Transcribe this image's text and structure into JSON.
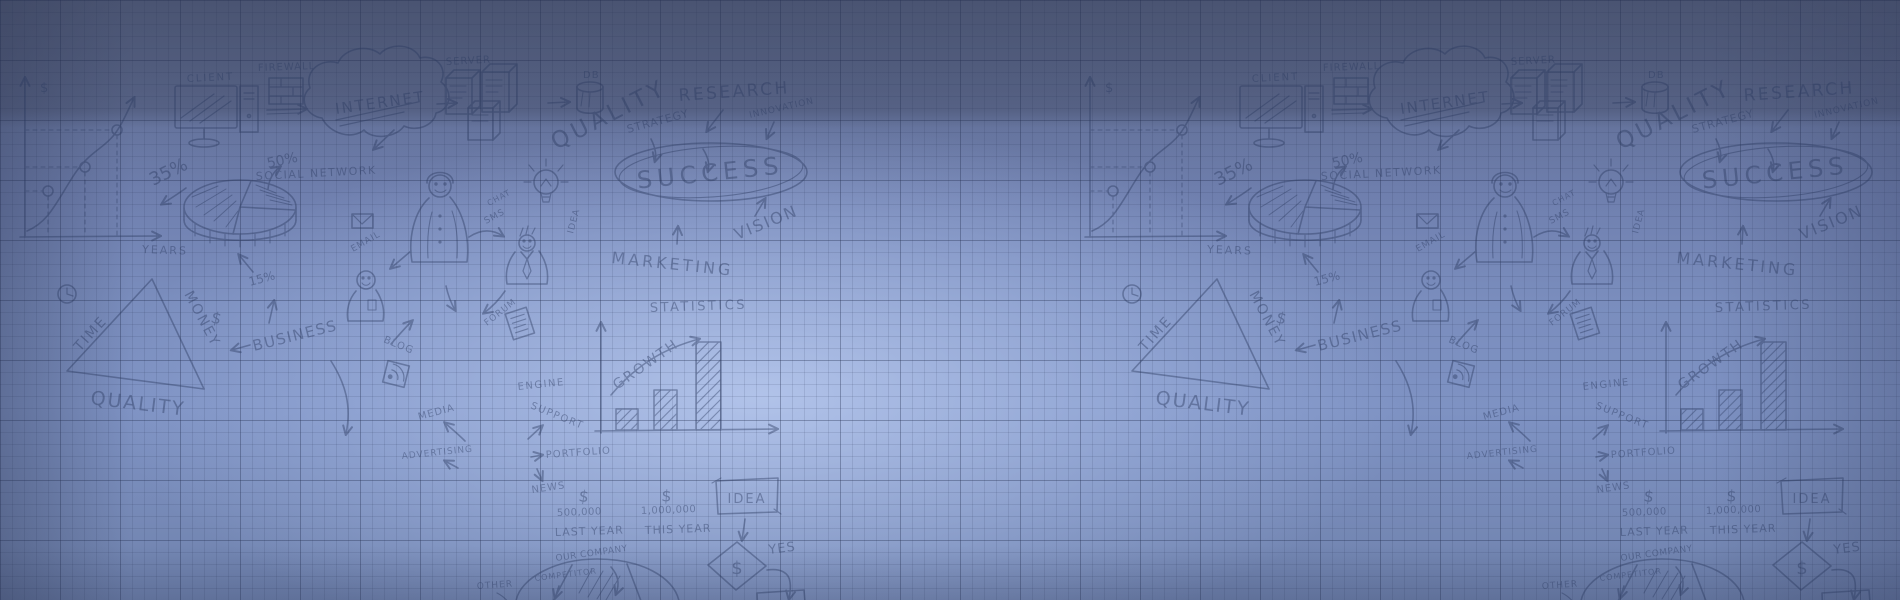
{
  "banner": {
    "theme": {
      "ink": "#2b3a60",
      "bg_top": "#525f80",
      "bg_mid": "#7b90c0",
      "bg_highlight": "#aec2ec",
      "bg_bottom": "#6f82ad",
      "grid_line": "#21305c"
    },
    "doodles": {
      "network": {
        "client": "CLIENT",
        "firewall": "FIREWALL",
        "internet": "INTERNET",
        "server": "SERVER",
        "db": "DB"
      },
      "concepts": {
        "quality": "QUALITY",
        "strategy": "STRATEGY",
        "research": "RESEARCH",
        "innovation": "INNOVATION",
        "success": "SUCCESS",
        "vision": "VISION",
        "marketing": "MARKETING",
        "idea": "IDEA",
        "social_network": "SOCIAL NETWORK"
      },
      "social": {
        "email": "EMAIL",
        "chat": "CHAT",
        "sms": "SMS",
        "blog": "BLOG",
        "forum": "FORUM"
      },
      "line_chart": {
        "currency": "$",
        "x_label": "YEARS"
      },
      "pie_chart": {
        "slice_a": "35%",
        "slice_b": "50%",
        "slice_c": "15%"
      },
      "triangle": {
        "left_side": "TIME",
        "right_side": "MONEY",
        "currency": "$",
        "base": "QUALITY",
        "business": "BUSINESS"
      },
      "bar_chart": {
        "title": "STATISTICS",
        "growth": "GROWTH"
      },
      "services": {
        "media": "MEDIA",
        "advertising": "ADVERTISING",
        "engine": "ENGINE",
        "support": "SUPPORT",
        "portfolio": "PORTFOLIO",
        "news": "NEWS"
      },
      "compare": {
        "currency": "$",
        "last_amount": "500,000",
        "last_label": "LAST YEAR",
        "this_amount": "1,000,000",
        "this_label": "THIS YEAR"
      },
      "flowchart": {
        "idea": "IDEA",
        "decision": "$",
        "yes": "YES"
      },
      "market_pie": {
        "our_company": "OUR COMPANY",
        "competitor": "COMPETITOR",
        "other": "OTHER"
      }
    }
  },
  "chart_data": [
    {
      "type": "line",
      "title": "",
      "xlabel": "YEARS",
      "ylabel": "$",
      "x": [
        1,
        2,
        3
      ],
      "y": [
        1,
        2,
        3.2
      ],
      "note_style": "sketched rising curve with three circled points and dashed guides"
    },
    {
      "type": "pie",
      "title": "",
      "labels": [
        "35%",
        "50%",
        "15%"
      ],
      "values": [
        35,
        50,
        15
      ]
    },
    {
      "type": "bar",
      "title": "STATISTICS",
      "annotation": "GROWTH",
      "categories": [
        "",
        "",
        ""
      ],
      "values": [
        0.25,
        0.45,
        1.0
      ],
      "ylim": [
        0,
        1
      ]
    },
    {
      "type": "bar",
      "title": "",
      "categories": [
        "LAST YEAR",
        "THIS YEAR"
      ],
      "values": [
        500000,
        1000000
      ],
      "value_labels": [
        "500,000",
        "1,000,000"
      ]
    },
    {
      "type": "pie",
      "title": "",
      "labels": [
        "OUR COMPANY",
        "COMPETITOR",
        "OTHER"
      ]
    }
  ]
}
